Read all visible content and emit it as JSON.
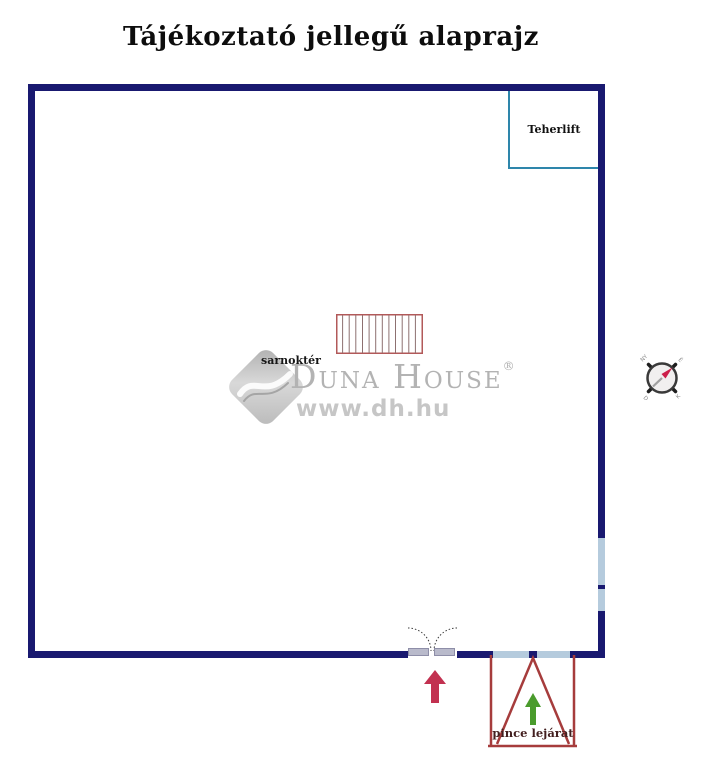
{
  "title": "Tájékoztató jellegű alaprajz",
  "plan": {
    "elevator_label": "Teherlift",
    "hall_label": "sarnoktér",
    "basement_label": "pince lejárat"
  },
  "watermark": {
    "brand": "Duna House",
    "registered_mark": "®",
    "url": "www.dh.hu"
  },
  "compass": {
    "north": "É",
    "east": "K",
    "south": "D",
    "west": "NY"
  },
  "colors": {
    "title_black": "#0d0d0d",
    "wall_navy": "#191970",
    "elevator_teal": "#2e86ab",
    "stair_red": "#b25959",
    "stair_tread": "#8d7070",
    "window_lightblue": "#b5cbdd",
    "door_leaf_gray": "#b9bacb",
    "entrance_arrow_red": "#c23150",
    "basement_red": "#a63c3c",
    "basement_arrow_green": "#4a9b2c",
    "basement_label_dark": "#431f1f",
    "watermark_gray": "#b3b3b3",
    "watermark_url_gray": "#c6c6c6",
    "compass_needle_red": "#cc1f4a",
    "compass_needle_gray": "#a0a0a0"
  }
}
